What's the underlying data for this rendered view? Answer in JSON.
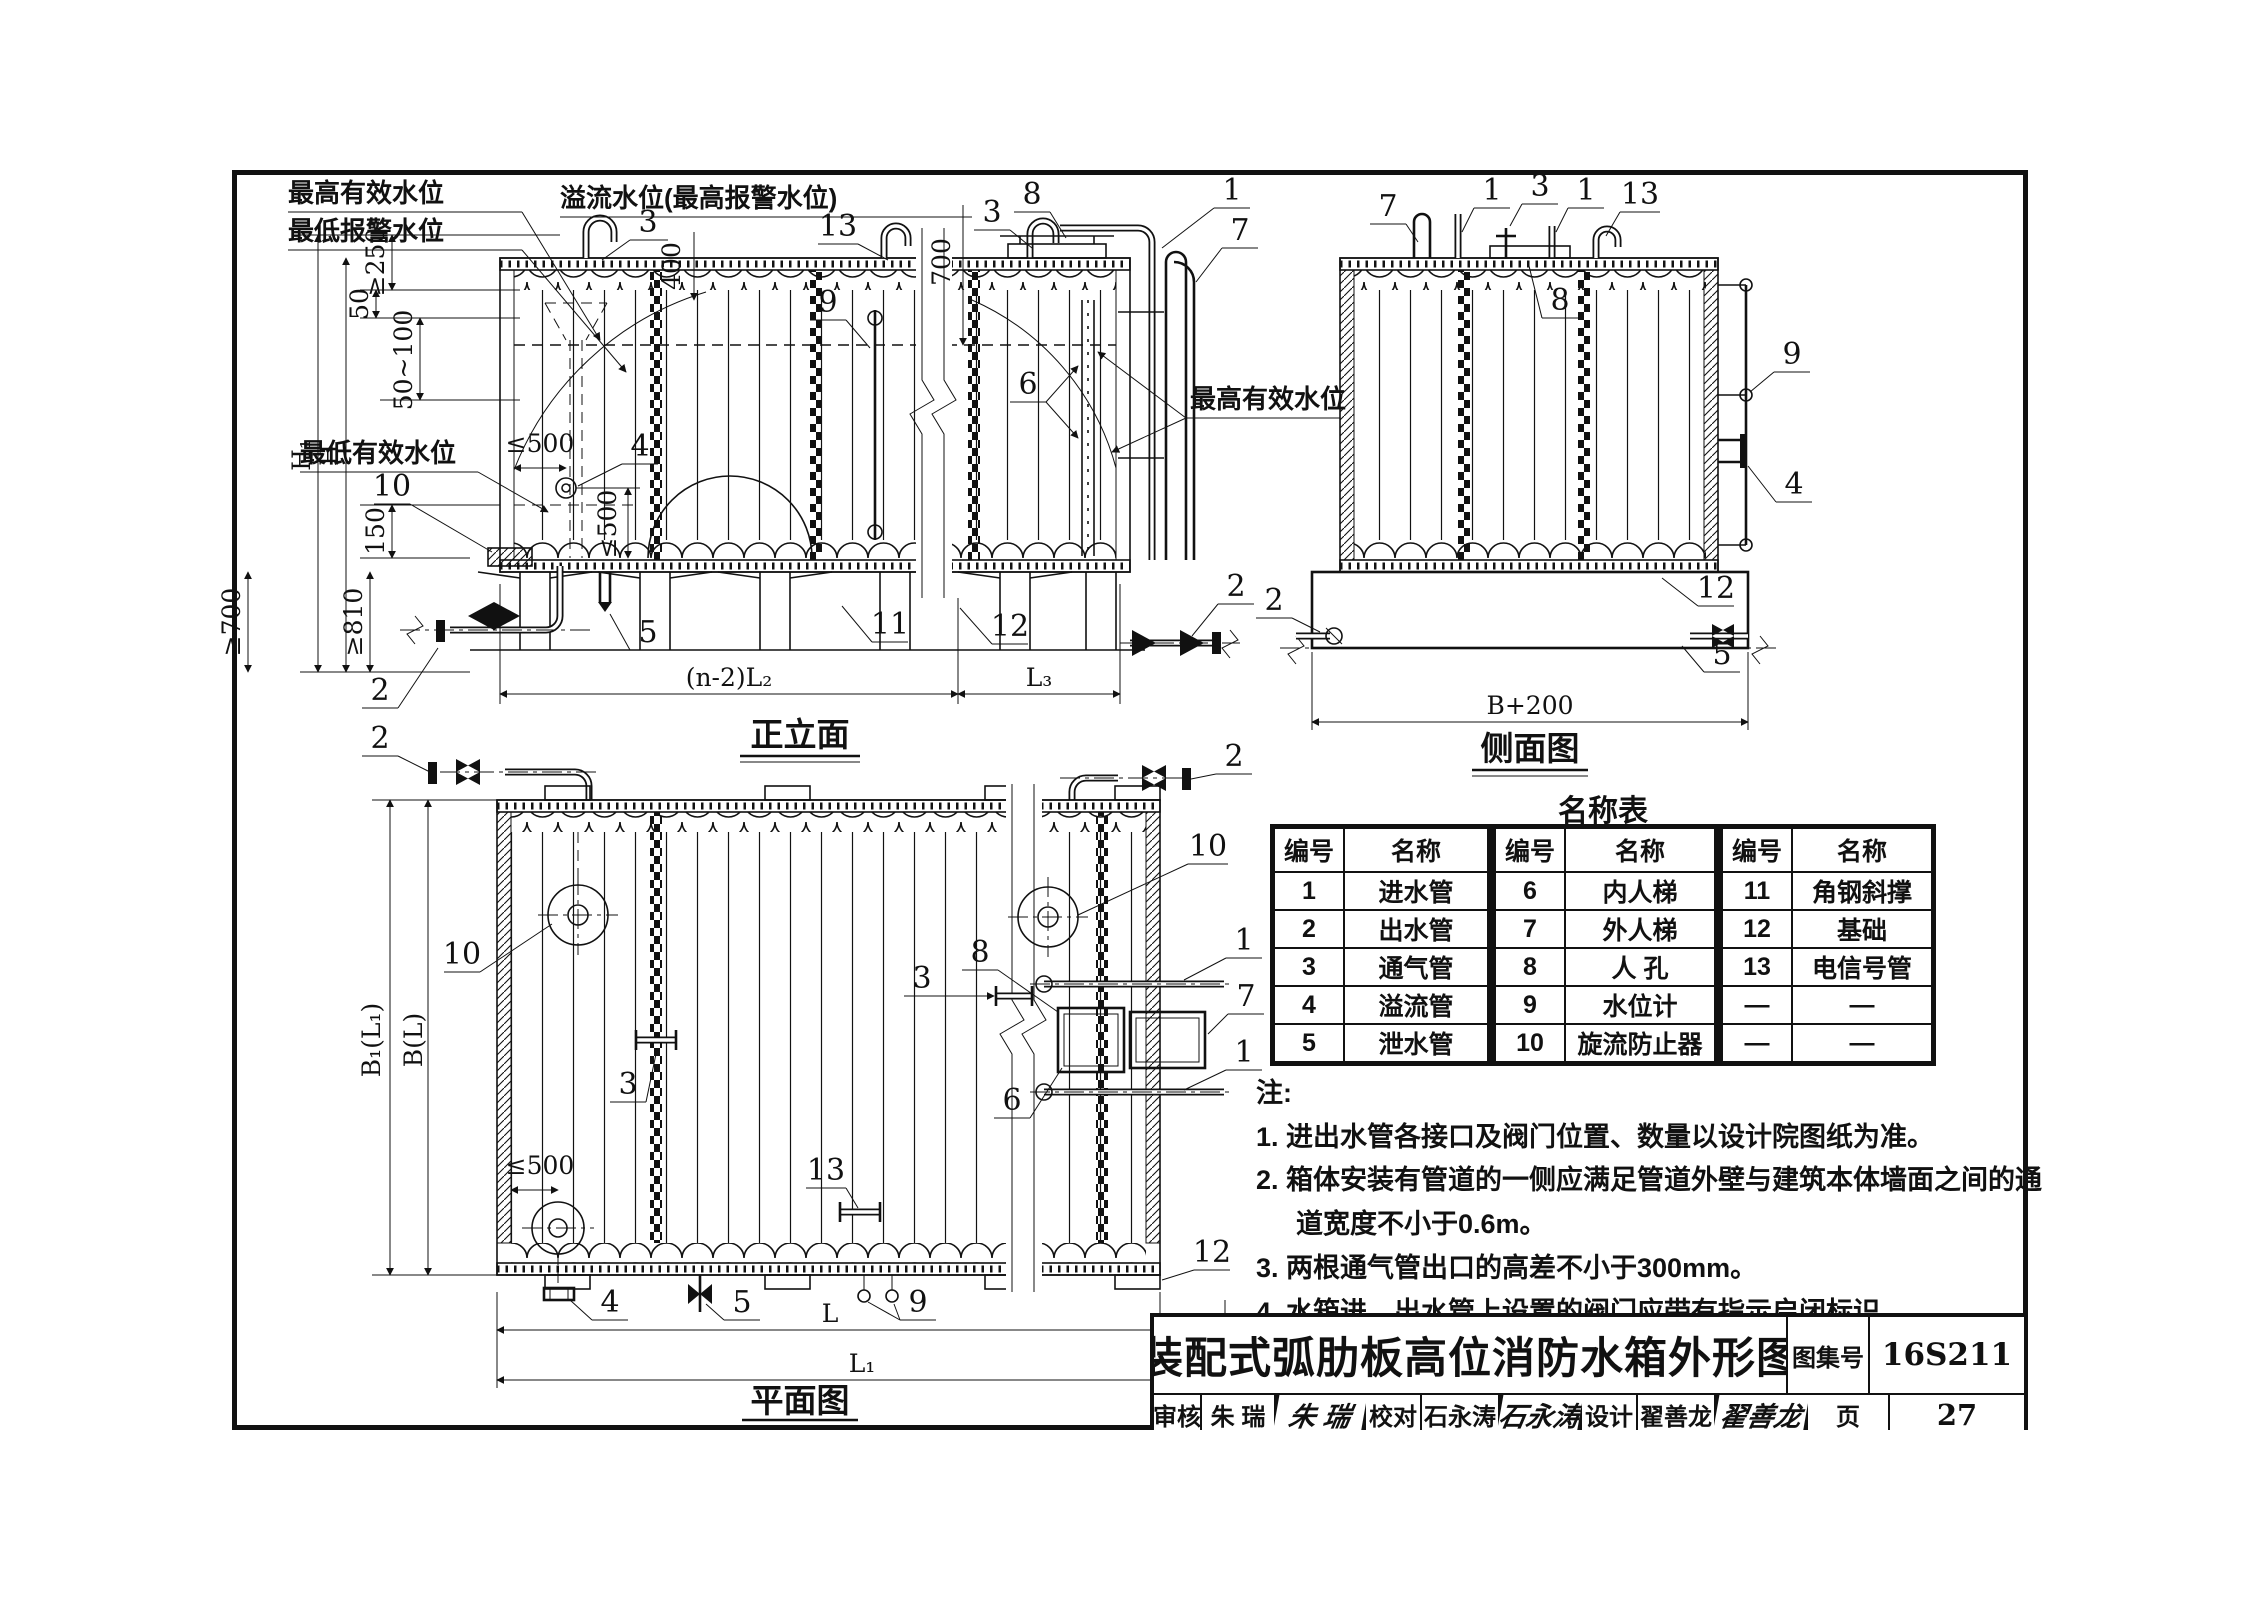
{
  "views": {
    "front": {
      "caption": "正立面",
      "levels": {
        "max_eff": "最高有效水位",
        "min_alarm": "最低报警水位",
        "overflow": "溢流水位(最高报警水位)",
        "min_eff": "最低有效水位",
        "max_eff_right": "最高有效水位"
      },
      "dims": {
        "v400": "400",
        "v700": "700",
        "ge250": "≥250",
        "v50": "50",
        "r50_100": "50~100",
        "h1": "H₁",
        "h": "H",
        "v150": "150",
        "ge700": "≥700",
        "ge810": "≥810",
        "le500_h": "≤500",
        "le500_v": "≤500",
        "span_mid": "(n-2)L₂",
        "span_right": "L₃"
      },
      "callouts": {
        "vent_a": "3",
        "signal": "13",
        "gauge": "9",
        "vent_b": "3",
        "manhole": "8",
        "inlet": "1",
        "ladder_ext": "7",
        "ladder_int": "6",
        "overflow_nozzle": "4",
        "vortex": "10",
        "drain": "5",
        "brace": "11",
        "foundation": "12",
        "outlet_left": "2",
        "outlet_right": "2",
        "feed_left": "2",
        "feed_right": "2"
      }
    },
    "side": {
      "caption": "侧面图",
      "dims": {
        "width": "B+200"
      },
      "callouts": {
        "ladder_ext": "7",
        "inlet_a": "1",
        "vent": "3",
        "inlet_b": "1",
        "signal": "13",
        "manhole": "8",
        "gauge": "9",
        "overflow_nozzle": "4",
        "foundation": "12",
        "drain": "5",
        "outlet": "2"
      }
    },
    "plan": {
      "caption": "平面图",
      "dims": {
        "b1l1": "B₁(L₁)",
        "bl": "B(L)",
        "le500": "≤500",
        "l": "L",
        "l1": "L₁"
      },
      "callouts": {
        "feed_left": "2",
        "feed_right": "2",
        "vortex_left": "10",
        "vortex_right": "10",
        "vent_left": "3",
        "vent_mid": "3",
        "manhole": "8",
        "ladder_int": "6",
        "inlet_top": "1",
        "ladder_ext": "7",
        "inlet_bot": "1",
        "signal": "13",
        "gauge": "9",
        "overflow": "4",
        "drain": "5",
        "foundation": "12"
      }
    }
  },
  "name_table": {
    "title": "名称表",
    "col_id": "编号",
    "col_name": "名称",
    "rows": [
      [
        "1",
        "进水管",
        "6",
        "内人梯",
        "11",
        "角钢斜撑"
      ],
      [
        "2",
        "出水管",
        "7",
        "外人梯",
        "12",
        "基础"
      ],
      [
        "3",
        "通气管",
        "8",
        "人 孔",
        "13",
        "电信号管"
      ],
      [
        "4",
        "溢流管",
        "9",
        "水位计",
        "—",
        "—"
      ],
      [
        "5",
        "泄水管",
        "10",
        "旋流防止器",
        "—",
        "—"
      ]
    ]
  },
  "notes": {
    "heading": "注:",
    "items": [
      "1. 进出水管各接口及阀门位置、数量以设计院图纸为准。",
      "2. 箱体安装有管道的一侧应满足管道外壁与建筑本体墙面之间的通道宽度不小于0.6m。",
      "3. 两根通气管出口的高差不小于300mm。",
      "4. 水箱进、出水管上设置的阀门应带有指示启闭标识。"
    ]
  },
  "title_block": {
    "title": "装配式弧肋板高位消防水箱外形图",
    "atlas_label": "图集号",
    "atlas_no": "16S211",
    "page_label": "页",
    "page_no": "27",
    "review_label": "审核",
    "reviewer": "朱 瑞",
    "reviewer_sig": "朱 瑞",
    "proof_label": "校对",
    "proofer": "石永涛",
    "proofer_sig": "石永涛",
    "design_label": "设计",
    "designer": "翟善龙",
    "designer_sig": "翟善龙"
  }
}
